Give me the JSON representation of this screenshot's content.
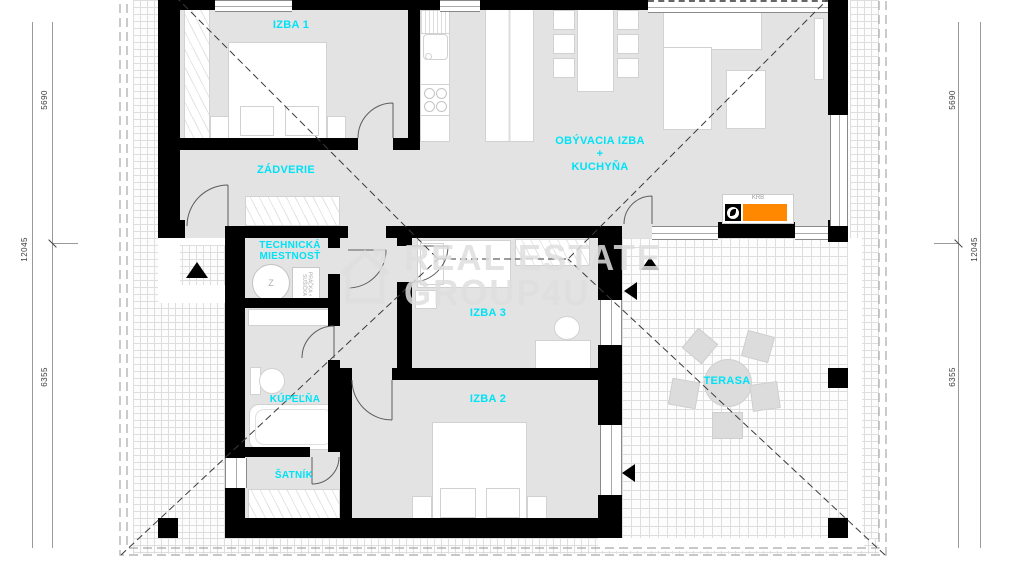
{
  "watermark": {
    "line1": "REAL ESTATE",
    "line2": "GROUP4U"
  },
  "rooms": {
    "izba1": "IZBA 1",
    "zadverie": "ZÁDVERIE",
    "living_1": "OBÝVACIA IZBA",
    "living_2": "+",
    "living_3": "KUCHYŇA",
    "technicka_1": "TECHNICKÁ",
    "technicka_2": "MIESTNOSŤ",
    "izba3": "IZBA 3",
    "kupelna": "KÚPEĽŇA",
    "satnik": "ŠATNÍK",
    "izba2": "IZBA 2",
    "terasa": "TERASA"
  },
  "annotations": {
    "fireplace": "KRB",
    "boiler": "Z",
    "laundry": "PRÁČKA + SUŠIČKA"
  },
  "dimensions": {
    "left": {
      "top": "5690",
      "middle": "12045",
      "bottom": "6355"
    },
    "right": {
      "top": "5690",
      "middle": "12045",
      "bottom": "6355"
    }
  },
  "colors": {
    "room_label": "#00e2f5",
    "fireplace_accent": "#ff8800",
    "wall": "#000000",
    "floor": "#e3e3e3",
    "paver_line": "#dedede"
  }
}
